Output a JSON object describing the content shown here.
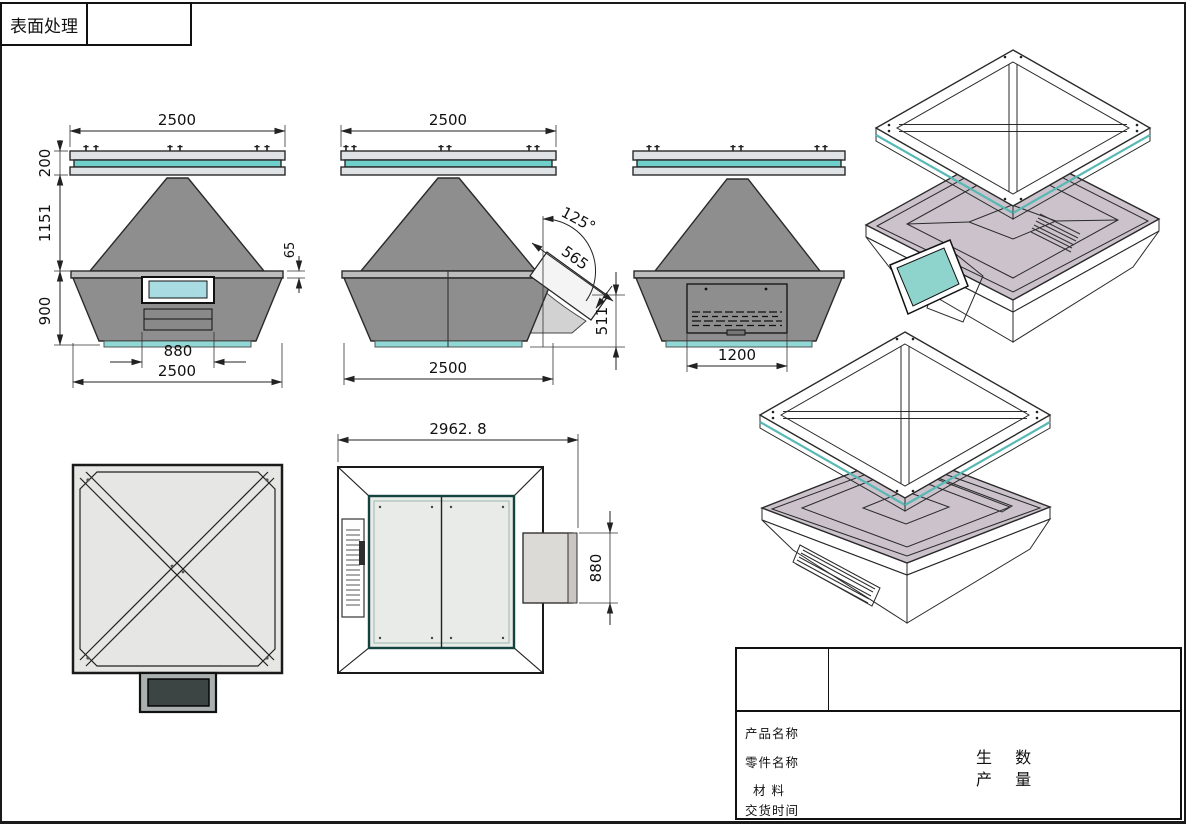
{
  "header": {
    "surface_treatment": "表面处理"
  },
  "dims": {
    "front": {
      "top_width": "2500",
      "panel_thickness": "200",
      "cone_height": "1151",
      "base_height": "900",
      "rim_height": "65",
      "screen_width": "880",
      "bottom_width": "2500"
    },
    "side": {
      "top_width": "2500",
      "duct_angle": "125°",
      "duct_length": "565",
      "duct_height": "511",
      "bottom_width": "2500"
    },
    "back": {
      "vent_width": "1200"
    },
    "plan": {
      "overall_width": "2962. 8",
      "duct_width": "880"
    }
  },
  "title_block": {
    "product_name_label": "产品名称",
    "part_name_label": "零件名称",
    "material_label": "材  料",
    "delivery_label": "交货时间",
    "qty_line1": "生 数",
    "qty_line2": "产 量"
  },
  "colors": {
    "body_gray": "#8e8e8e",
    "rim_gray": "#bcbcbc",
    "panel_light": "#dfe3e6",
    "teal": "#6fcfca",
    "screen_cyan": "#a8dce2",
    "strip_cyan": "#8fd8d5",
    "iso_purple_light": "#cbc2cb",
    "iso_purple_dark": "#b0a5b1",
    "outline": "#2a2a2a"
  }
}
